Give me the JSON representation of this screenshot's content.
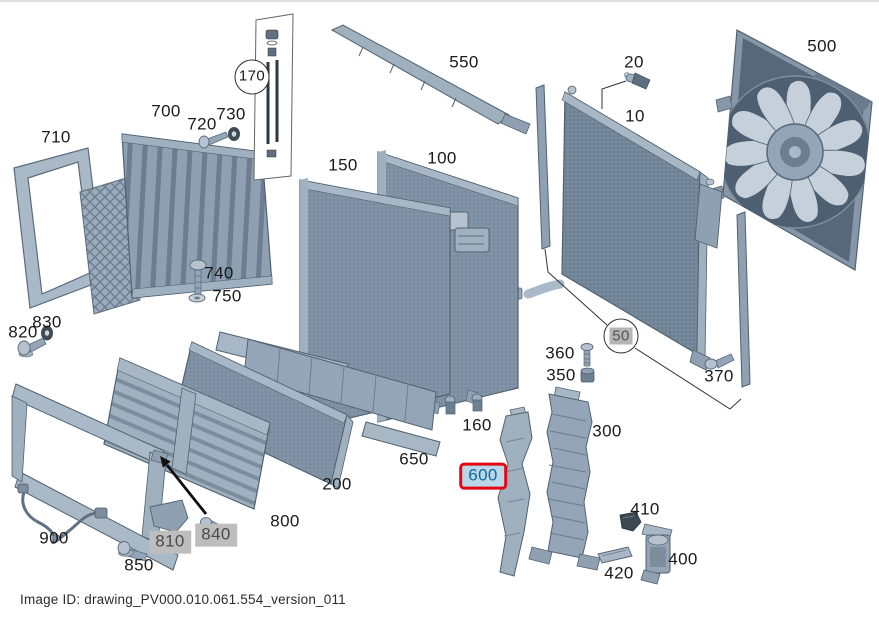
{
  "window": {
    "width": 879,
    "height": 618,
    "background": "#ffffff"
  },
  "caption": {
    "image_id_label": "Image ID: drawing_PV000.010.061.554_version_011"
  },
  "colors": {
    "highlight_border": "#e30613",
    "highlight_bg": "#b9d7e8",
    "highlight_text": "#13679f",
    "unavailable_bg": "#bdbdbd",
    "unavailable_text": "#4a4a4a",
    "label_text": "#1a1a1a",
    "part_light": "#c5d0da",
    "part_mid": "#93a5b6",
    "part_dark": "#5d6f81",
    "leader_line": "#333333"
  },
  "diagram": {
    "type": "exploded-parts-drawing",
    "highlighted_label": "600",
    "unavailable_labels": [
      "50",
      "810",
      "840"
    ],
    "labels": [
      {
        "text": "710",
        "x": 56,
        "y": 136,
        "variant": "plain"
      },
      {
        "text": "700",
        "x": 166,
        "y": 110,
        "variant": "plain"
      },
      {
        "text": "720",
        "x": 202,
        "y": 123,
        "variant": "plain"
      },
      {
        "text": "730",
        "x": 231,
        "y": 113,
        "variant": "plain"
      },
      {
        "text": "170",
        "x": 252,
        "y": 75,
        "variant": "circled"
      },
      {
        "text": "550",
        "x": 464,
        "y": 61,
        "variant": "plain"
      },
      {
        "text": "150",
        "x": 343,
        "y": 164,
        "variant": "plain"
      },
      {
        "text": "100",
        "x": 442,
        "y": 157,
        "variant": "plain"
      },
      {
        "text": "20",
        "x": 634,
        "y": 61,
        "variant": "plain"
      },
      {
        "text": "10",
        "x": 635,
        "y": 115,
        "variant": "plain"
      },
      {
        "text": "500",
        "x": 822,
        "y": 45,
        "variant": "plain"
      },
      {
        "text": "740",
        "x": 219,
        "y": 272,
        "variant": "plain"
      },
      {
        "text": "750",
        "x": 227,
        "y": 295,
        "variant": "plain"
      },
      {
        "text": "830",
        "x": 47,
        "y": 321,
        "variant": "plain"
      },
      {
        "text": "820",
        "x": 23,
        "y": 331,
        "variant": "plain"
      },
      {
        "text": "50",
        "x": 621,
        "y": 334,
        "variant": "circled-gray"
      },
      {
        "text": "370",
        "x": 719,
        "y": 375,
        "variant": "plain"
      },
      {
        "text": "360",
        "x": 560,
        "y": 352,
        "variant": "plain"
      },
      {
        "text": "350",
        "x": 561,
        "y": 374,
        "variant": "plain"
      },
      {
        "text": "160",
        "x": 477,
        "y": 424,
        "variant": "plain"
      },
      {
        "text": "650",
        "x": 414,
        "y": 458,
        "variant": "plain"
      },
      {
        "text": "200",
        "x": 337,
        "y": 483,
        "variant": "plain"
      },
      {
        "text": "600",
        "x": 483,
        "y": 474,
        "variant": "highlight"
      },
      {
        "text": "300",
        "x": 607,
        "y": 430,
        "variant": "plain"
      },
      {
        "text": "410",
        "x": 645,
        "y": 508,
        "variant": "plain"
      },
      {
        "text": "420",
        "x": 619,
        "y": 572,
        "variant": "plain"
      },
      {
        "text": "400",
        "x": 683,
        "y": 558,
        "variant": "plain"
      },
      {
        "text": "800",
        "x": 285,
        "y": 520,
        "variant": "plain"
      },
      {
        "text": "810",
        "x": 170,
        "y": 540,
        "variant": "graybox"
      },
      {
        "text": "840",
        "x": 216,
        "y": 533,
        "variant": "graybox"
      },
      {
        "text": "850",
        "x": 139,
        "y": 564,
        "variant": "plain"
      },
      {
        "text": "900",
        "x": 54,
        "y": 537,
        "variant": "plain"
      }
    ]
  }
}
